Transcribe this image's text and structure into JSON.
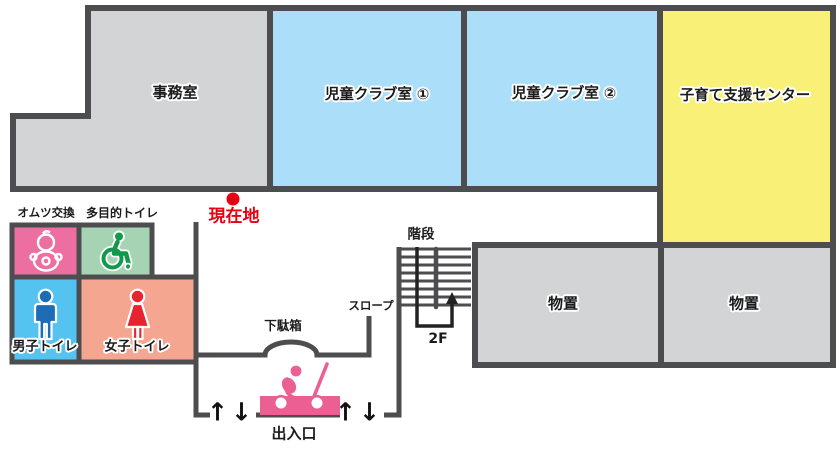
{
  "map_title": "施設フロアマップ",
  "rooms": {
    "office": {
      "label": "事務室",
      "color": "#d3d4d6"
    },
    "kids_club_1": {
      "label": "児童クラブ室 ①",
      "color": "#abdef8"
    },
    "kids_club_2": {
      "label": "児童クラブ室 ②",
      "color": "#abdef8"
    },
    "childcare_support_center": {
      "label": "子育て支援センター",
      "color": "#f9f077"
    },
    "storage_1": {
      "label": "物置",
      "color": "#d3d4d6"
    },
    "storage_2": {
      "label": "物置",
      "color": "#d3d4d6"
    }
  },
  "amenities": {
    "diaper_change": {
      "label": "オムツ交換",
      "color": "#ed6ea0"
    },
    "multipurpose_toilet": {
      "label": "多目的トイレ",
      "color": "#a5d3b4",
      "icon_color": "#129a4b"
    },
    "mens_toilet": {
      "label": "男子トイレ",
      "color": "#55c3f0",
      "icon_color": "#1d6cb5"
    },
    "womens_toilet": {
      "label": "女子トイレ",
      "color": "#f4a691",
      "icon_color": "#e6232e"
    }
  },
  "annotations": {
    "current_location": {
      "label": "現在地",
      "color": "#e60012"
    },
    "shoe_box": {
      "label": "下駄箱"
    },
    "slope": {
      "label": "スロープ"
    },
    "stairs": {
      "label": "階段"
    },
    "to_floor": {
      "label": "2F"
    },
    "entrance": {
      "label": "出入口"
    },
    "arrow_up": "↑",
    "arrow_down": "↓",
    "stroller_color": "#ec5f92"
  },
  "wall_color": "#4d4d4f"
}
